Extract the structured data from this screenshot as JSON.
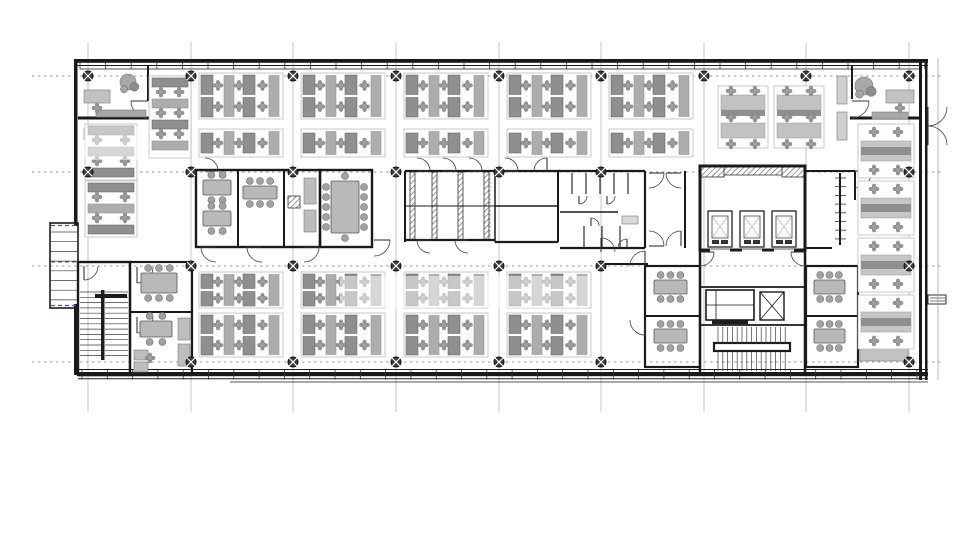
{
  "meta": {
    "title": "Office floor plan - open plan workstations with central core (WC block, lift bank, stairs) and structural grid",
    "canvas_w": 975,
    "canvas_h": 535,
    "bg": "#ffffff"
  },
  "palette": {
    "wall": "#1a1a1a",
    "wall_mid": "#333333",
    "grid_v": "#b9b9b9",
    "grid_h": "#9b9b9b",
    "desk_light": "#c6c6c6",
    "desk_mid": "#adadad",
    "desk_dark": "#8f8f8f",
    "chair": "#9e9e9e",
    "chair_edge": "#6e6e6e",
    "accent_blue": "#4055b0",
    "marker": "#3a3a3a",
    "tread": "#3c3c3c",
    "watermark": "rgba(255,255,255,0.5)"
  },
  "grid": {
    "v_x": [
      88,
      191,
      293,
      396,
      499,
      601,
      704,
      806,
      909
    ],
    "v_y1": 42,
    "v_y2": 412,
    "h_y": [
      76,
      172,
      266,
      362
    ],
    "h_x1": 32,
    "h_x2": 942
  },
  "markers": [
    [
      88,
      76
    ],
    [
      191,
      76
    ],
    [
      293,
      76
    ],
    [
      396,
      76
    ],
    [
      499,
      76
    ],
    [
      601,
      76
    ],
    [
      704,
      76
    ],
    [
      806,
      76
    ],
    [
      909,
      76
    ],
    [
      88,
      172
    ],
    [
      191,
      172
    ],
    [
      293,
      172
    ],
    [
      396,
      172
    ],
    [
      499,
      172
    ],
    [
      601,
      172
    ],
    [
      909,
      172
    ],
    [
      191,
      266
    ],
    [
      293,
      266
    ],
    [
      396,
      266
    ],
    [
      499,
      266
    ],
    [
      601,
      266
    ],
    [
      909,
      266
    ],
    [
      191,
      362
    ],
    [
      293,
      362
    ],
    [
      396,
      362
    ],
    [
      499,
      362
    ],
    [
      601,
      362
    ],
    [
      909,
      362
    ]
  ],
  "thick_rects": [
    [
      74,
      59,
      854,
      3.8
    ],
    [
      74,
      59,
      3.5,
      167
    ],
    [
      74,
      304,
      3.5,
      71
    ],
    [
      919,
      59,
      3,
      321
    ],
    [
      925,
      59,
      2.5,
      321
    ],
    [
      78,
      372,
      850,
      4.2
    ]
  ],
  "tick_runs": [
    {
      "x0": 80,
      "x1": 925,
      "step": 25.6,
      "y1": 62,
      "y2": 69
    },
    {
      "x0": 82,
      "x1": 926,
      "step": 25.3,
      "y1": 369,
      "y2": 379.5
    }
  ],
  "fin_runs": [
    {
      "y0": 178,
      "y1": 240,
      "step": 8.7,
      "x1": 835,
      "x2": 846
    }
  ],
  "wall_lines": [
    [
      74,
      65.5,
      928,
      65.5,
      1
    ],
    [
      80,
      69,
      922,
      69,
      0.7
    ],
    [
      78,
      369.5,
      928,
      369.5,
      1
    ],
    [
      78,
      378.8,
      928,
      378.8,
      1
    ],
    [
      230,
      382,
      928,
      382,
      0.7
    ],
    [
      78,
      118,
      152,
      118,
      3
    ],
    [
      148,
      66,
      148,
      101,
      2
    ],
    [
      850,
      118,
      922,
      118,
      3
    ],
    [
      852,
      66,
      852,
      99,
      2
    ],
    [
      238,
      170,
      238,
      247,
      2
    ],
    [
      284,
      170,
      284,
      247,
      2
    ],
    [
      405,
      171,
      495,
      171,
      2.2
    ],
    [
      405,
      240,
      495,
      240,
      2.2
    ],
    [
      405,
      171,
      405,
      242,
      2
    ],
    [
      495,
      171,
      495,
      242,
      1.5
    ],
    [
      405,
      206,
      495,
      206,
      1
    ],
    [
      495,
      171,
      560,
      171,
      2.2
    ],
    [
      495,
      242,
      558,
      242,
      2.2
    ],
    [
      558,
      171,
      558,
      242,
      2
    ],
    [
      495,
      206,
      558,
      206,
      1.5
    ],
    [
      558,
      171,
      645,
      171,
      2.2
    ],
    [
      560,
      248,
      645,
      248,
      2.2
    ],
    [
      645,
      171,
      645,
      248,
      2.2
    ],
    [
      572,
      173,
      572,
      194,
      1.1
    ],
    [
      586,
      173,
      586,
      194,
      1.1
    ],
    [
      600,
      173,
      600,
      194,
      1.1
    ],
    [
      614,
      173,
      614,
      194,
      1.1
    ],
    [
      628,
      173,
      628,
      194,
      1.1
    ],
    [
      560,
      212,
      618,
      212,
      1.5
    ],
    [
      584,
      226,
      584,
      248,
      1.1
    ],
    [
      602,
      226,
      602,
      248,
      1.1
    ],
    [
      620,
      226,
      620,
      248,
      1.1
    ],
    [
      685,
      171,
      685,
      248,
      2
    ],
    [
      805,
      171,
      855,
      171,
      2
    ],
    [
      855,
      171,
      855,
      200,
      2
    ],
    [
      840,
      173,
      840,
      245,
      2
    ],
    [
      805,
      248,
      832,
      248,
      2
    ],
    [
      700,
      250,
      700,
      375,
      2.5
    ],
    [
      805,
      250,
      805,
      375,
      2.5
    ],
    [
      700,
      287,
      805,
      287,
      1.8
    ],
    [
      700,
      325,
      805,
      325,
      1.8
    ],
    [
      645,
      316,
      700,
      316,
      2
    ],
    [
      806,
      316,
      858,
      316,
      2
    ],
    [
      601,
      264,
      648,
      264,
      2
    ],
    [
      130,
      312,
      192,
      312,
      2
    ],
    [
      716,
      290,
      716,
      320,
      0.8
    ],
    [
      706,
      305,
      754,
      305,
      0.8
    ],
    [
      760,
      292,
      784,
      320,
      0.8
    ],
    [
      784,
      292,
      760,
      320,
      0.8
    ],
    [
      930,
      298,
      946,
      298,
      0.6
    ],
    [
      930,
      301,
      946,
      301,
      0.6
    ]
  ],
  "room_outlines": [
    [
      196,
      170,
      124,
      77,
      2.4
    ],
    [
      320,
      170,
      52,
      77,
      2.4
    ],
    [
      700,
      166,
      105,
      84,
      3
    ],
    [
      645,
      266,
      55,
      101,
      2.2
    ],
    [
      806,
      266,
      52,
      101,
      2.2
    ],
    [
      78,
      262,
      52,
      113,
      2.4
    ],
    [
      130,
      262,
      62,
      113,
      2.2
    ],
    [
      50,
      223,
      28,
      85,
      1.6
    ],
    [
      706,
      290,
      48,
      30,
      1.6
    ],
    [
      760,
      292,
      24,
      28,
      1.4
    ],
    [
      714,
      343,
      76,
      8,
      2.2
    ],
    [
      928,
      295,
      18,
      9,
      0.9
    ]
  ],
  "hatch_rects": [
    [
      410,
      172,
      5,
      68
    ],
    [
      432,
      172,
      5,
      68
    ],
    [
      458,
      172,
      5,
      68
    ],
    [
      484,
      172,
      5,
      68
    ],
    [
      288,
      196,
      12,
      12
    ],
    [
      700,
      166,
      24,
      11
    ],
    [
      782,
      166,
      23,
      11
    ],
    [
      724,
      167,
      58,
      8
    ]
  ],
  "dashed_lines": [
    [
      51,
      225.5,
      77,
      225.5,
      "#4055b0",
      1.2,
      "4,3"
    ],
    [
      51,
      305.5,
      77,
      305.5,
      "#4055b0",
      1.2,
      "4,3"
    ],
    [
      51,
      262,
      77,
      262,
      "#4055b0",
      1,
      "4,3"
    ],
    [
      490,
      174,
      490,
      238,
      "#909090",
      0.8,
      "1.5,2.5"
    ],
    [
      938,
      58,
      938,
      380,
      "#9a9a9a",
      0.7,
      ""
    ]
  ],
  "doors": [
    [
      148,
      101,
      17,
      90,
      180
    ],
    [
      852,
      101,
      17,
      90,
      0
    ],
    [
      417,
      171,
      13,
      -90,
      0
    ],
    [
      443,
      171,
      13,
      -90,
      0
    ],
    [
      469,
      171,
      13,
      -90,
      0
    ],
    [
      430,
      240,
      13,
      90,
      180
    ],
    [
      468,
      240,
      13,
      90,
      180
    ],
    [
      505,
      171,
      13,
      -90,
      0
    ],
    [
      547,
      171,
      13,
      180,
      270
    ],
    [
      649,
      173,
      15,
      90,
      0
    ],
    [
      681,
      173,
      15,
      90,
      180
    ],
    [
      649,
      246,
      15,
      -90,
      0
    ],
    [
      681,
      246,
      15,
      180,
      270
    ],
    [
      579,
      196,
      8,
      0,
      90
    ],
    [
      607,
      196,
      8,
      0,
      90
    ],
    [
      591,
      226,
      8,
      0,
      -90
    ],
    [
      627,
      248,
      9,
      180,
      270
    ],
    [
      855,
      171,
      17,
      90,
      0
    ],
    [
      700,
      252,
      14,
      90,
      0
    ],
    [
      805,
      252,
      14,
      90,
      180
    ],
    [
      645,
      266,
      15,
      180,
      270
    ],
    [
      645,
      320,
      15,
      180,
      90
    ],
    [
      858,
      282,
      15,
      -90,
      0
    ],
    [
      858,
      335,
      15,
      90,
      0
    ],
    [
      216,
      247,
      15,
      90,
      180
    ],
    [
      262,
      247,
      15,
      90,
      180
    ],
    [
      304,
      247,
      15,
      90,
      0
    ],
    [
      374,
      240,
      16,
      90,
      0
    ],
    [
      137,
      267,
      16,
      0,
      90
    ],
    [
      137,
      317,
      16,
      0,
      90
    ],
    [
      84,
      266,
      14,
      0,
      90
    ],
    [
      205,
      171,
      13,
      -90,
      0
    ],
    [
      601,
      252,
      14,
      0,
      -90
    ],
    [
      928,
      107,
      19,
      0,
      90
    ],
    [
      928,
      145,
      19,
      0,
      -90
    ]
  ],
  "treads": [
    {
      "type": "v",
      "x": 51,
      "y": 232,
      "w": 26,
      "h": 70,
      "step": 9.7
    },
    {
      "type": "v",
      "x": 80,
      "y": 292,
      "w": 21,
      "h": 66,
      "step": 5.3
    },
    {
      "type": "v",
      "x": 105,
      "y": 292,
      "w": 23,
      "h": 66,
      "step": 5.3
    },
    {
      "type": "h",
      "x": 718,
      "y": 327,
      "w": 68,
      "h": 17,
      "step": 4.8
    },
    {
      "type": "h",
      "x": 718,
      "y": 352,
      "w": 68,
      "h": 19,
      "step": 4.8
    }
  ],
  "dark_rects": [
    [
      101,
      290,
      3.5,
      70
    ],
    [
      95,
      294,
      32,
      4
    ],
    [
      712,
      320,
      36,
      4
    ]
  ],
  "fill_rects": [
    [
      96,
      110,
      50,
      7,
      "#a8a8a8"
    ],
    [
      872,
      112,
      36,
      7,
      "#a8a8a8"
    ],
    [
      84,
      90,
      26,
      13,
      "#c2c2c2"
    ],
    [
      886,
      90,
      28,
      13,
      "#c2c2c2"
    ],
    [
      84,
      128,
      20,
      12,
      "#c2c2c2"
    ],
    [
      860,
      348,
      48,
      13,
      "#c2c2c2"
    ],
    [
      304,
      178,
      12,
      26,
      "#bdbdbd"
    ],
    [
      304,
      210,
      12,
      22,
      "#bdbdbd"
    ],
    [
      178,
      318,
      12,
      22,
      "#bdbdbd"
    ],
    [
      178,
      344,
      12,
      22,
      "#bdbdbd"
    ],
    [
      134,
      350,
      14,
      10,
      "#bdbdbd"
    ],
    [
      134,
      362,
      14,
      10,
      "#bdbdbd"
    ],
    [
      622,
      216,
      16,
      8,
      "#d8d8d8"
    ],
    [
      837,
      76,
      10,
      28,
      "#cfcfcf"
    ],
    [
      837,
      112,
      10,
      28,
      "#cfcfcf"
    ],
    [
      710,
      247.5,
      20,
      4,
      "#ffffff"
    ],
    [
      742,
      247.5,
      20,
      4,
      "#ffffff"
    ],
    [
      774,
      247.5,
      20,
      4,
      "#ffffff"
    ]
  ],
  "elevators": [
    [
      708,
      211,
      24,
      36
    ],
    [
      740,
      211,
      24,
      36
    ],
    [
      772,
      211,
      24,
      36
    ]
  ],
  "clusters_h": [
    [
      199,
      73,
      84,
      46
    ],
    [
      301,
      73,
      84,
      46
    ],
    [
      404,
      73,
      84,
      46
    ],
    [
      507,
      73,
      84,
      46
    ],
    [
      609,
      73,
      84,
      46
    ],
    [
      199,
      272,
      84,
      36
    ],
    [
      301,
      272,
      84,
      36
    ],
    [
      404,
      272,
      84,
      36
    ],
    [
      507,
      272,
      84,
      36
    ],
    [
      199,
      313,
      84,
      44
    ],
    [
      301,
      313,
      84,
      44
    ],
    [
      404,
      313,
      84,
      44
    ],
    [
      507,
      313,
      84,
      44
    ]
  ],
  "clusters_h1": [
    [
      199,
      129,
      84,
      28
    ],
    [
      301,
      129,
      84,
      28
    ],
    [
      404,
      129,
      84,
      28
    ],
    [
      507,
      129,
      84,
      28
    ],
    [
      609,
      129,
      84,
      28
    ]
  ],
  "clusters_v": [
    [
      85,
      124,
      52,
      56
    ],
    [
      85,
      181,
      52,
      56
    ],
    [
      149,
      76,
      42,
      82
    ]
  ],
  "clusters_vs": [
    [
      858,
      124,
      56,
      54
    ],
    [
      858,
      181,
      56,
      54
    ],
    [
      858,
      238,
      56,
      54
    ],
    [
      858,
      295,
      56,
      54
    ]
  ],
  "clusters_t": [
    [
      718,
      86,
      50,
      62
    ],
    [
      774,
      86,
      50,
      62
    ]
  ],
  "tables": [
    [
      331,
      181,
      28,
      52,
      "v12"
    ],
    [
      203,
      180,
      28,
      15,
      "h4"
    ],
    [
      203,
      211,
      28,
      15,
      "h4"
    ],
    [
      243,
      186,
      34,
      13,
      "h6"
    ],
    [
      141,
      273,
      36,
      20,
      "h6"
    ],
    [
      140,
      321,
      32,
      16,
      "h4"
    ],
    [
      654,
      280,
      33,
      14,
      "h6"
    ],
    [
      654,
      329,
      33,
      14,
      "h6"
    ],
    [
      814,
      280,
      31,
      14,
      "h6"
    ],
    [
      814,
      329,
      31,
      14,
      "h6"
    ]
  ],
  "plants": [
    [
      128,
      82,
      8
    ],
    [
      864,
      86,
      9
    ]
  ],
  "loose_chairs": [
    [
      97,
      108
    ],
    [
      900,
      108
    ],
    [
      150,
      358
    ]
  ],
  "watermarks": [
    [
      84,
      126,
      64,
      34
    ],
    [
      340,
      276,
      250,
      32
    ]
  ]
}
